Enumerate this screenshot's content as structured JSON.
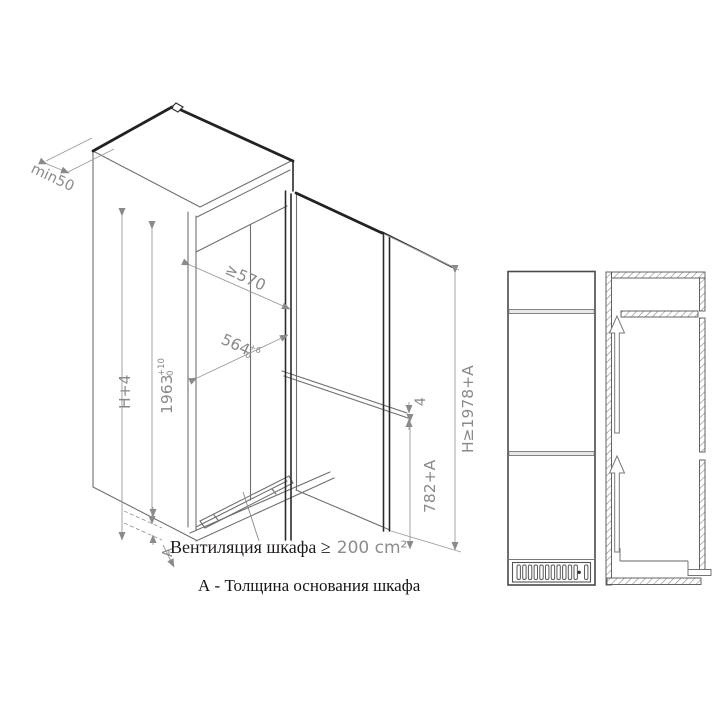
{
  "diagram3d": {
    "labels": {
      "rear_gap": "min50",
      "depth": "≥570",
      "width_main": "564",
      "width_sup": "+6",
      "width_sub": "0",
      "height_h4": "H+4",
      "niche_main": "1963",
      "niche_sup": "+10",
      "niche_sub": "0",
      "total_height": "H≥1978+A",
      "door_gap": "4",
      "lower_door": "782+A",
      "base_letter": "A"
    }
  },
  "notes": {
    "ventilation_prefix": "Вентиляция шкафа ≥",
    "ventilation_value": "200 cm²",
    "base_definition": "А - Толщина основания шкафа"
  },
  "icons": {
    "airflow_arrow": "up-arrow",
    "vent_grille": "grille-slats"
  },
  "colors": {
    "background": "#ffffff",
    "thin_line": "#6a6a6a",
    "thick_line": "#222222",
    "dimension_line": "#999999",
    "dimension_text": "#8a8a8a",
    "note_text": "#1f1b1b",
    "note_value": "#8c8c8c"
  }
}
